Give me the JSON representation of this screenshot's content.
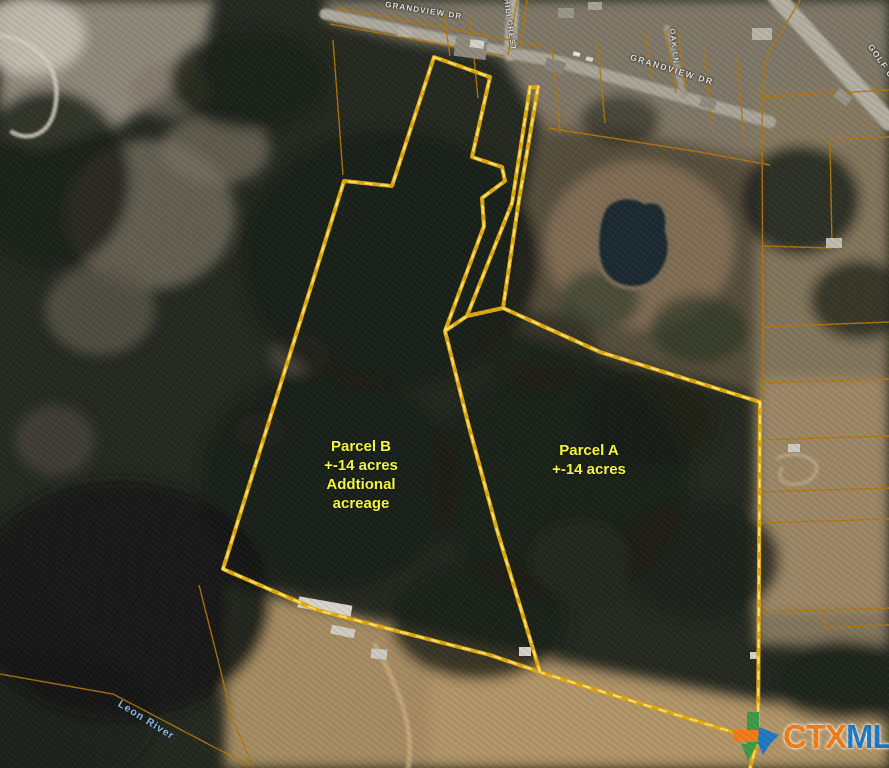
{
  "map": {
    "parcels": {
      "b": {
        "name": "Parcel B",
        "size": "+-14 acres",
        "note1": "Addtional",
        "note2": "acreage"
      },
      "a": {
        "name": "Parcel A",
        "size": "+-14 acres"
      }
    },
    "roads": {
      "grandview_nw": "GRANDVIEW DR",
      "hillcrest": "HILLCREST",
      "oak_ln": "OAK LN",
      "grandview_e": "GRANDVIEW DR",
      "golf_course": "GOLF COURSE",
      "leon_river": "Leon River"
    },
    "watermark": {
      "ctx": "CTX",
      "mls": "MLS"
    },
    "colors": {
      "boundary": "#e0a90f",
      "boundary_highlight": "#ffe97a",
      "neighbor_line": "#b5780d",
      "parcel_text": "#f9f943",
      "road_text": "#e3e2da",
      "river_text": "#93b9e6",
      "ctx_orange": "#f07d1a",
      "mls_blue": "#1f7ac4"
    }
  }
}
